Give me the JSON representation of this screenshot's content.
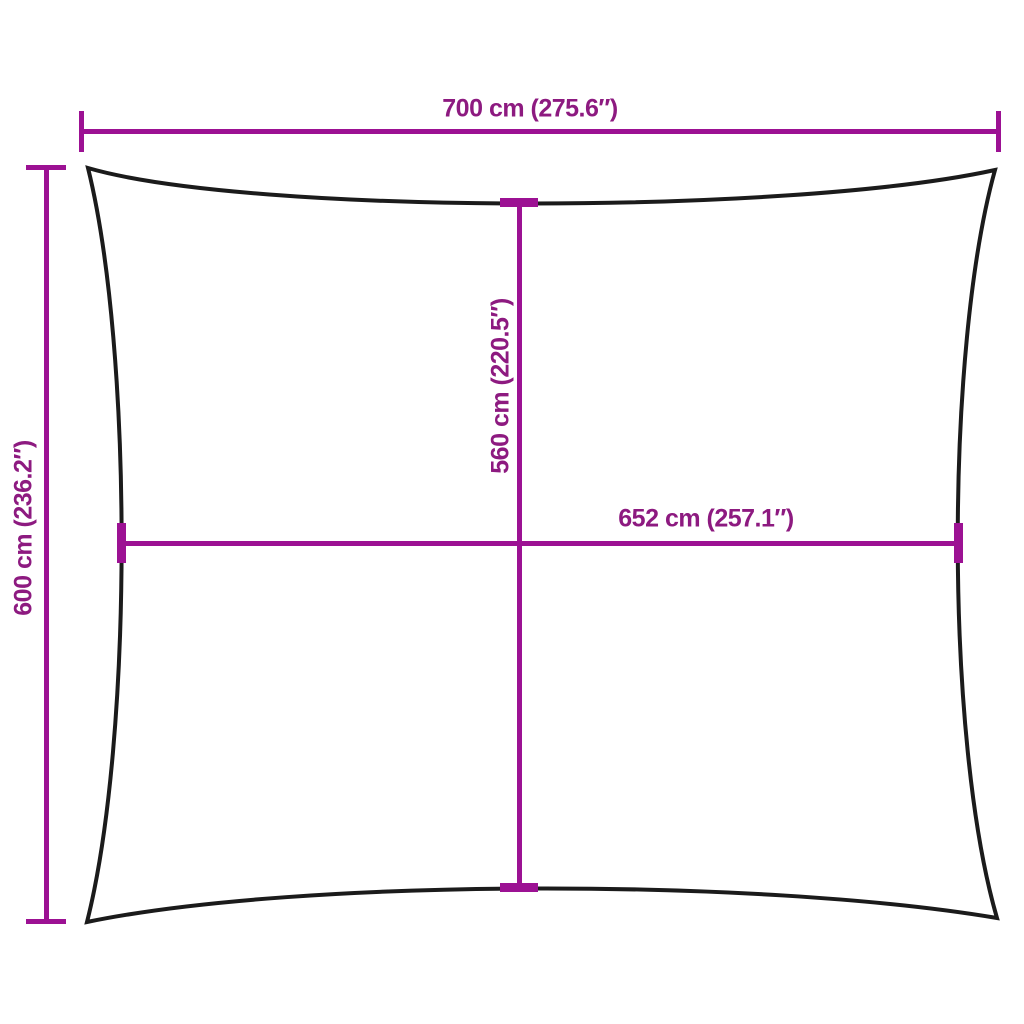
{
  "diagram": {
    "type": "product-dimension-diagram",
    "subject": "rectangular shade sail outline with concave edges",
    "background_color": "#ffffff",
    "outline_color": "#1b1b1b",
    "dimension_line_color": "#9C1193",
    "dimension_text_color": "#8D1A80",
    "labels": {
      "top_width": "700 cm (275.6″)",
      "left_height": "600 cm (236.2″)",
      "middle_vertical": "560 cm (220.5″)",
      "middle_horizontal": "652 cm (257.1″)"
    }
  }
}
